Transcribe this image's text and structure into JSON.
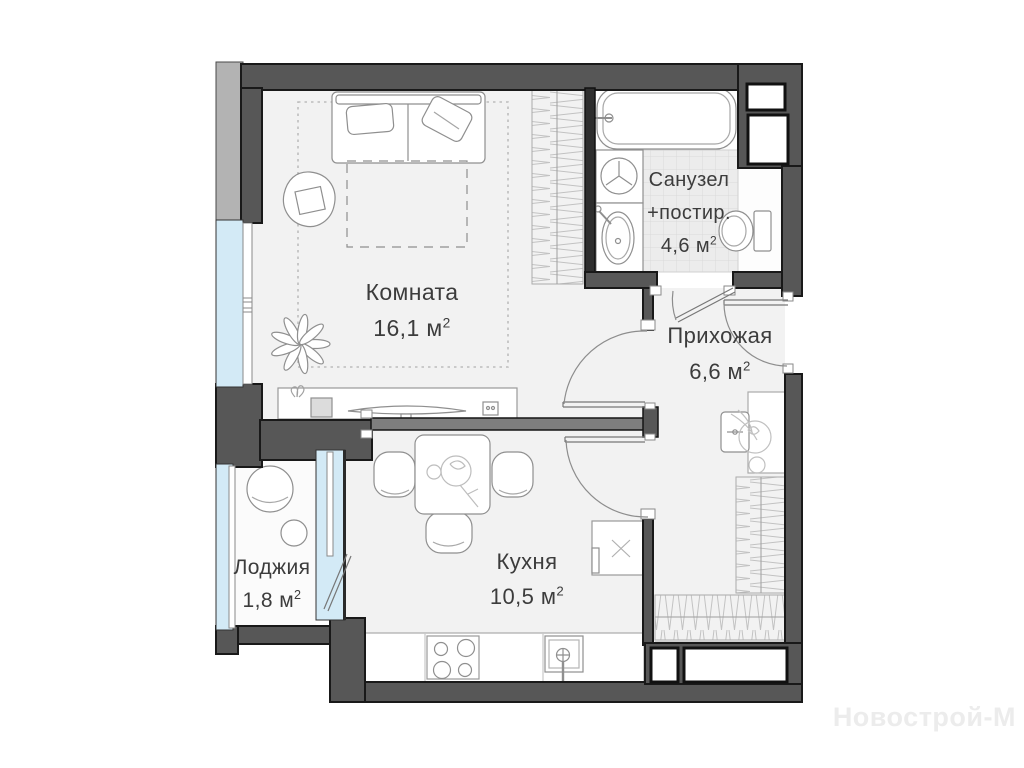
{
  "rooms": [
    {
      "id": "komnata",
      "name": "Комната",
      "area": "16,1"
    },
    {
      "id": "sanuzel",
      "name": "Санузел",
      "extra": "+постир.",
      "area": "4,6"
    },
    {
      "id": "prihozhaya",
      "name": "Прихожая",
      "area": "6,6"
    },
    {
      "id": "kuhnya",
      "name": "Кухня",
      "area": "10,5"
    },
    {
      "id": "lodzhiya",
      "name": "Лоджия",
      "area": "1,8"
    }
  ],
  "unit": " м",
  "sup": "2",
  "watermark": "Новострой-М",
  "colors": {
    "wall_dark": "#575757",
    "wall_outer": "#b3b3b3",
    "partition": "#7e7e7e",
    "glass": "#d3eaf6",
    "floor": "#f2f2f2",
    "tile": "#ececec",
    "label_text": "#3c3c3c",
    "watermark": "#ececec"
  }
}
